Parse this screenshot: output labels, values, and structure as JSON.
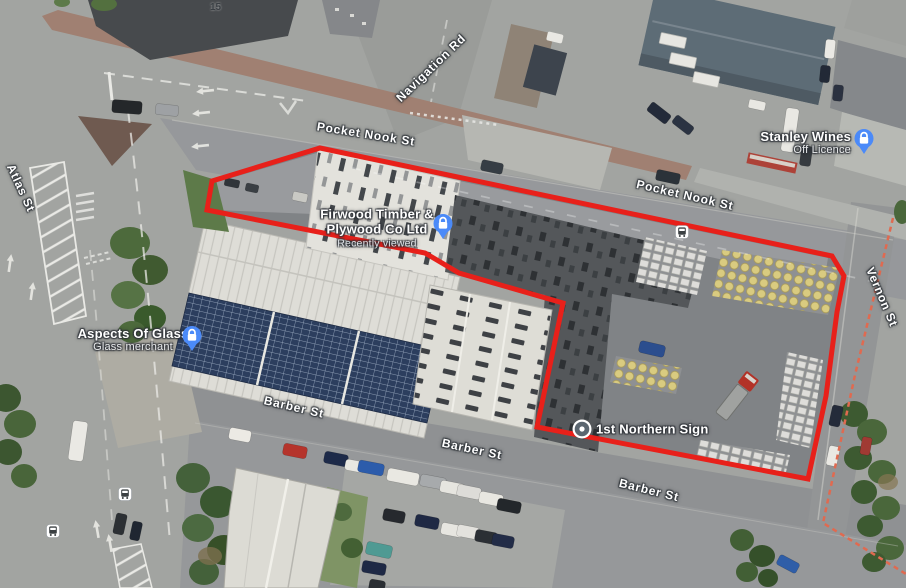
{
  "streets": {
    "navigation_rd": "Navigation Rd",
    "pocket_nook_st_upper": "Pocket Nook St",
    "pocket_nook_st_lower": "Pocket Nook St",
    "atlas_st": "Atlas St",
    "vernon_st": "Vernon St",
    "barber_st_west": "Barber St",
    "barber_st_mid": "Barber St",
    "barber_st_east": "Barber St"
  },
  "house_number": "15",
  "places": {
    "stanley_wines": {
      "name": "Stanley Wines",
      "category": "Off Licence",
      "icon": "lock-icon"
    },
    "firwood_timber": {
      "name_line1": "Firwood Timber &",
      "name_line2": "Plywood Co Ltd",
      "status": "Recently viewed",
      "icon": "lock-icon"
    },
    "aspects_of_glass": {
      "name": "Aspects Of Glass",
      "category": "Glass merchant",
      "icon": "lock-icon"
    },
    "first_northern_sign": {
      "name": "1st Northern Sign",
      "icon": "dot-marker-icon"
    }
  },
  "transit": {
    "icon": "bus-stop-icon",
    "stop_count": 3
  },
  "overlay": {
    "site_boundary": "red-outline-polygon",
    "adjacent_boundary": "red-dashed-line"
  },
  "colors": {
    "boundary_red": "#e8201a",
    "boundary_dashed_red": "#e06a50",
    "marker_blue": "#4b8af8",
    "solar_panel_blue": "#2c3e5e",
    "road_grey": "#a2a4a1"
  }
}
